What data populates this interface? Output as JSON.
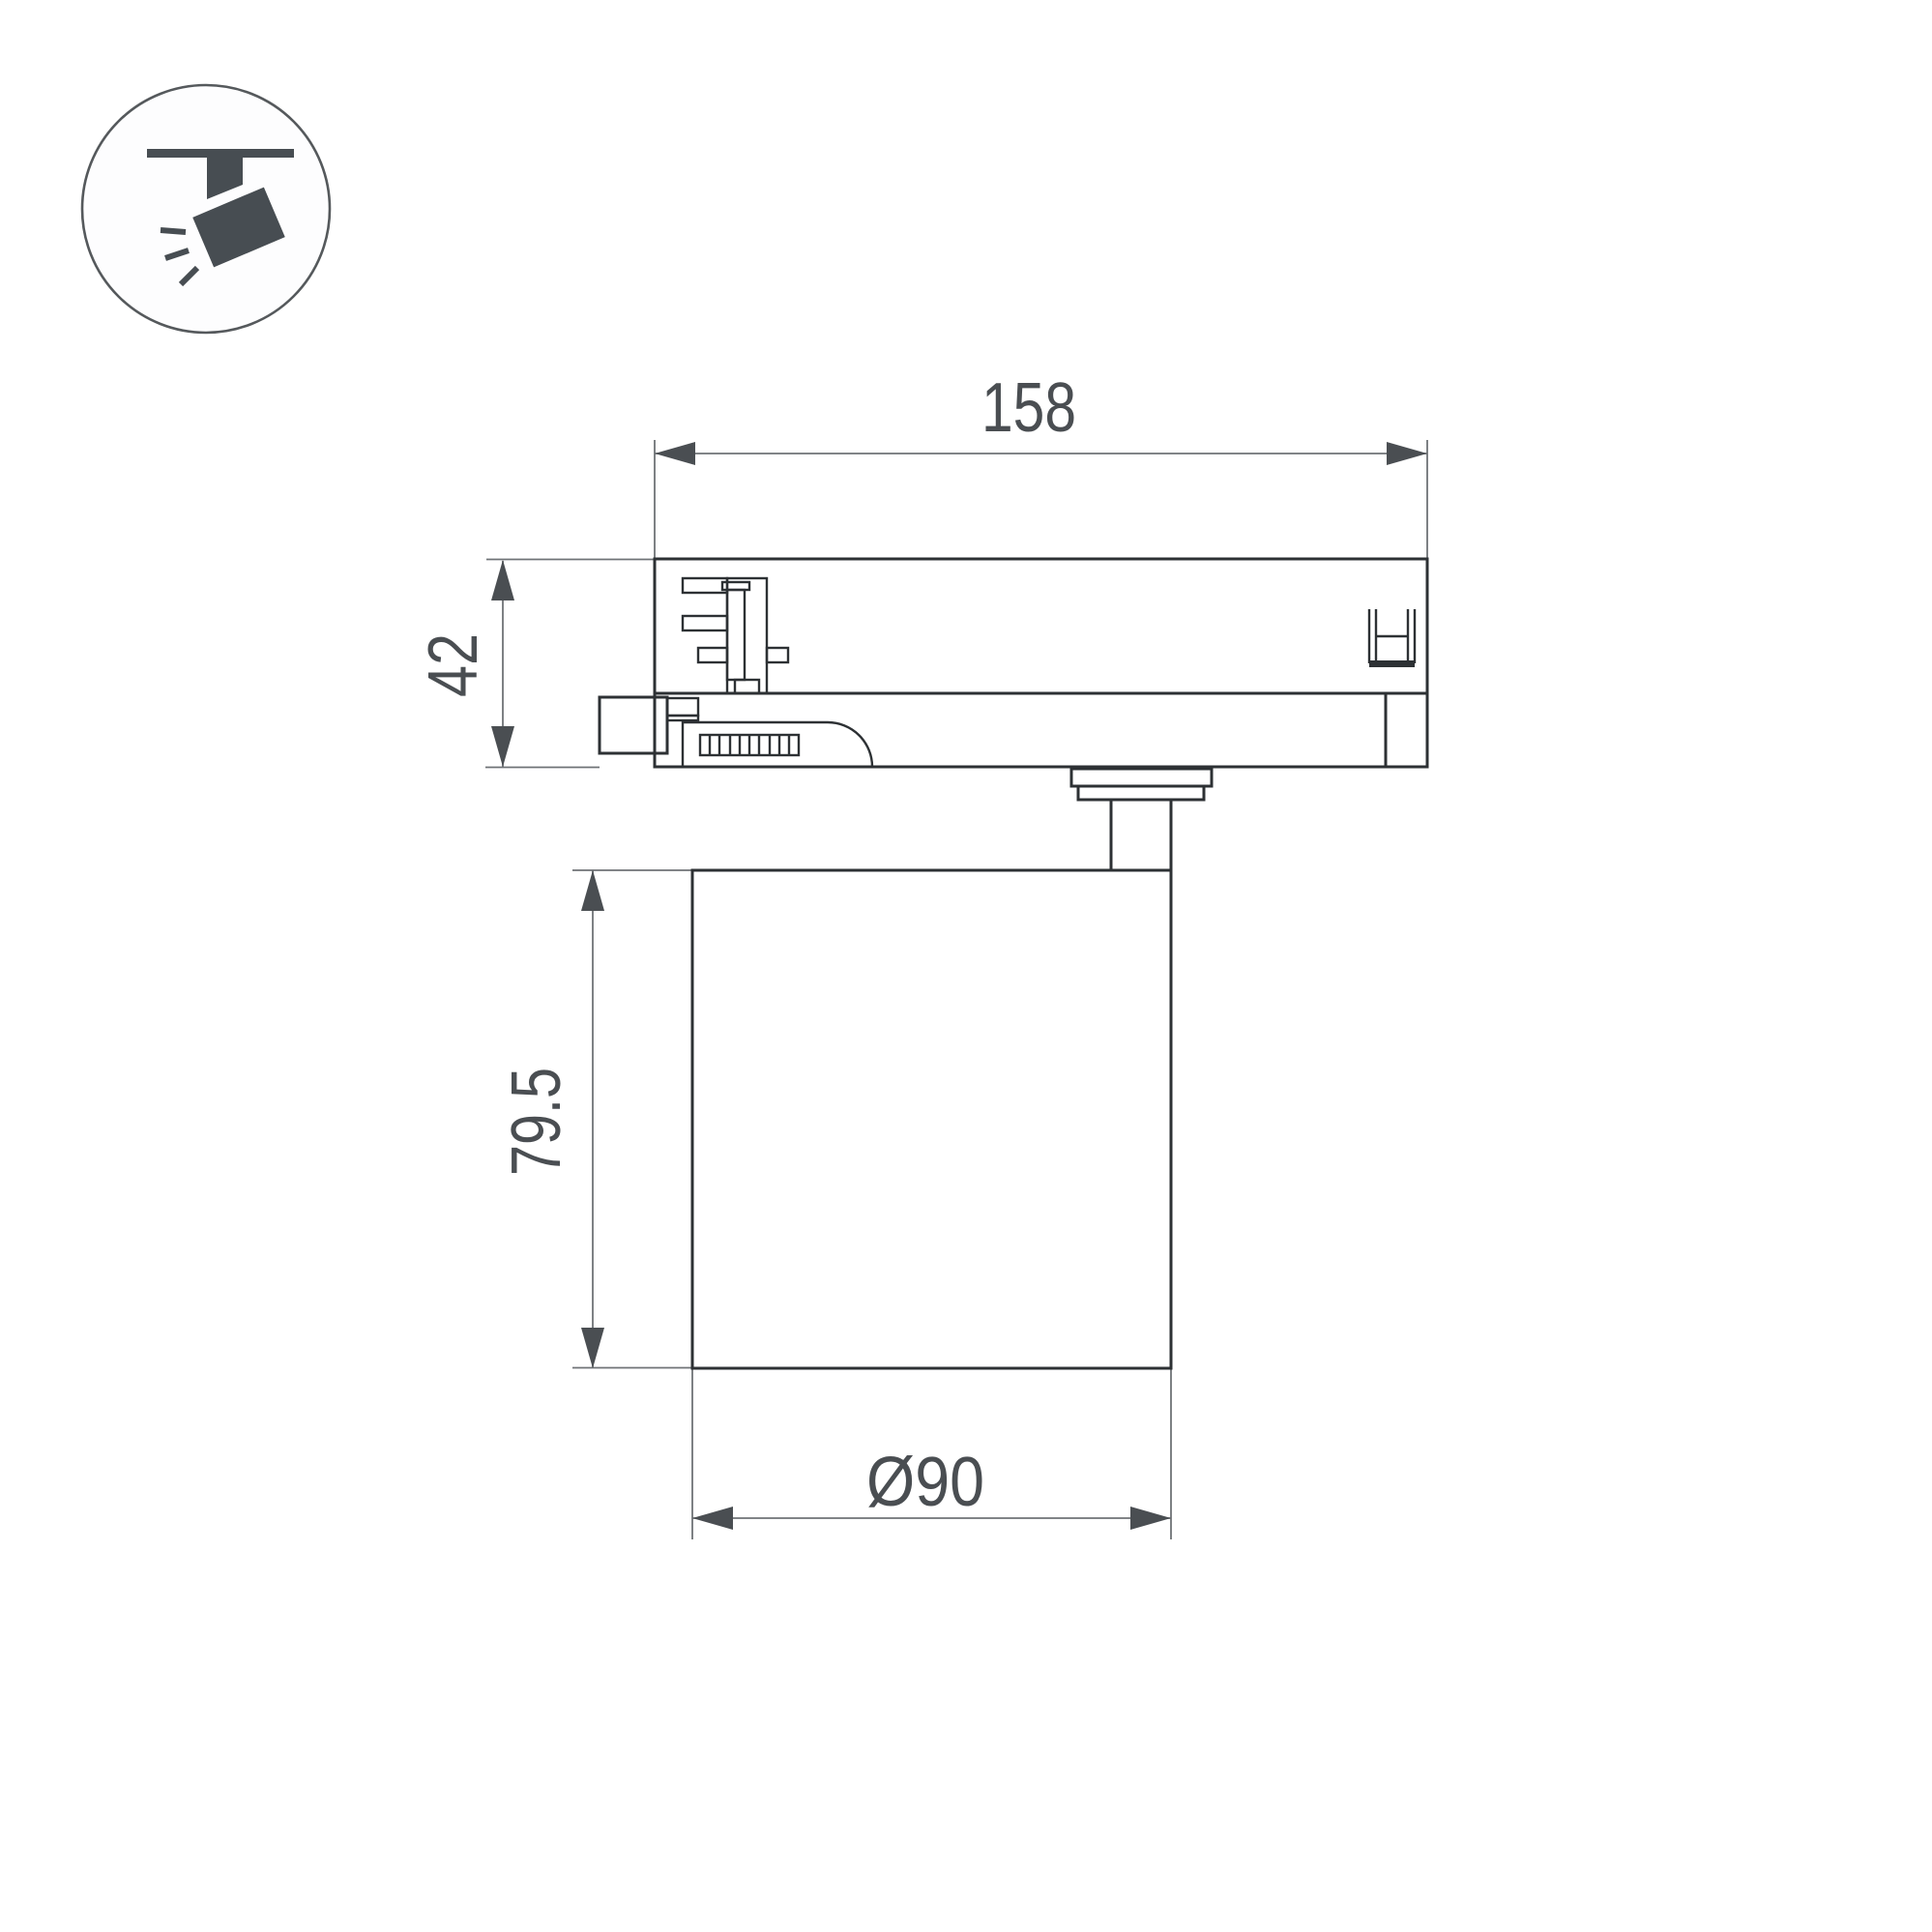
{
  "page": {
    "background": "#ffffff",
    "kind": "technical-dimension-drawing"
  },
  "icon": {
    "name": "track-spotlight-icon"
  },
  "drawing": {
    "part_name": "track-light-fixture-side-view"
  },
  "dimensions": {
    "track_adapter_length": {
      "label": "158"
    },
    "track_adapter_height": {
      "label": "42"
    },
    "body_height": {
      "label": "79.5"
    },
    "body_diameter": {
      "label": "Ø90"
    }
  },
  "colors": {
    "outline": "#2d3134",
    "dimension_lines": "#6f7376",
    "annotation": "#4a4e52",
    "icon_glyph": "#474d52"
  }
}
